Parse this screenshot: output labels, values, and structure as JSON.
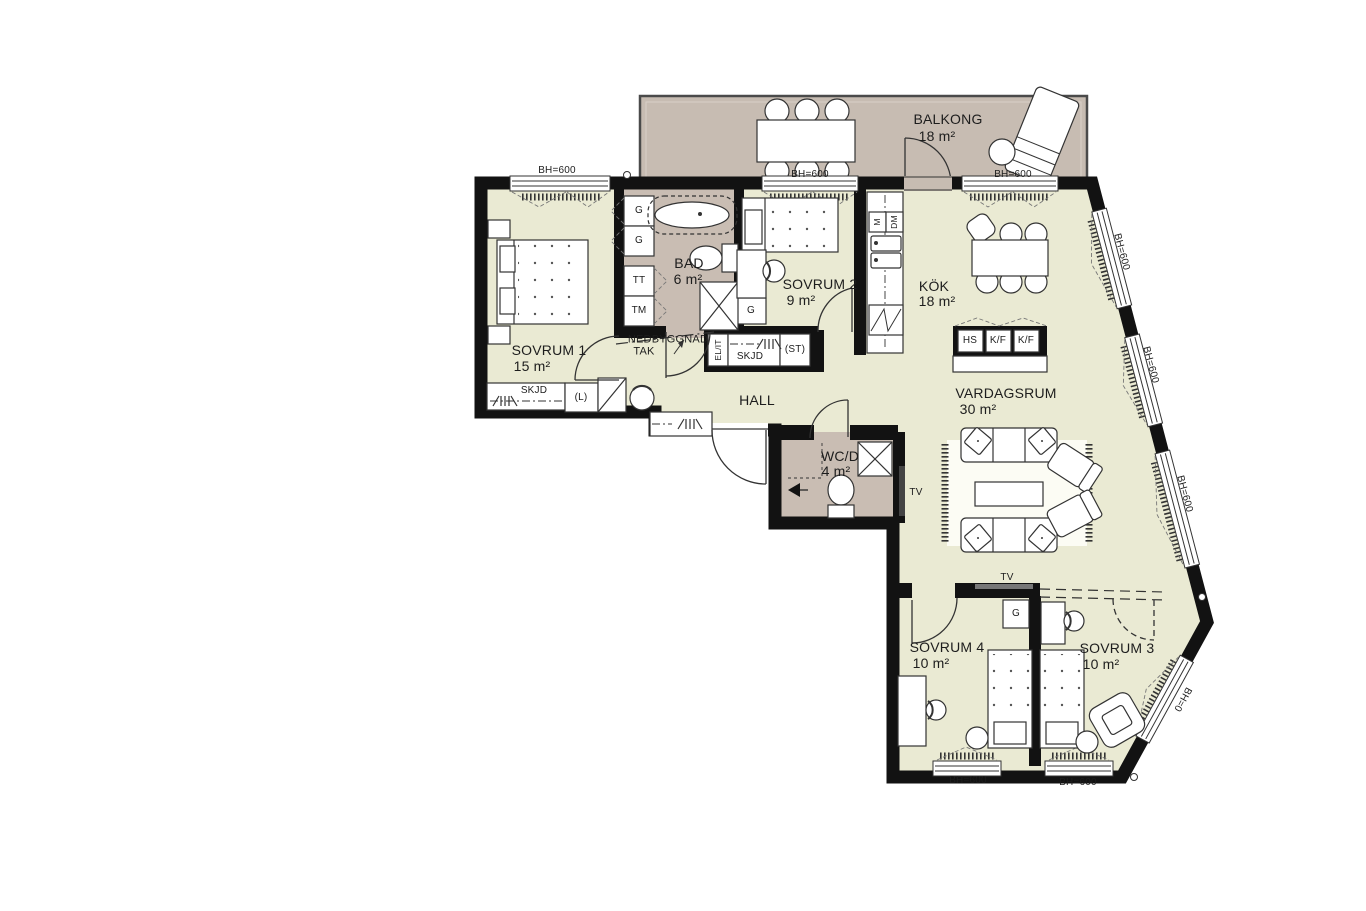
{
  "plan": {
    "rooms": {
      "balkong": {
        "name": "BALKONG",
        "area": "18 m²"
      },
      "sovrum1": {
        "name": "SOVRUM 1",
        "area": "15 m²"
      },
      "bad": {
        "name": "BAD",
        "area": "6 m²"
      },
      "sovrum2": {
        "name": "SOVRUM 2",
        "area": "9 m²"
      },
      "kok": {
        "name": "KÖK",
        "area": "18 m²"
      },
      "hall": {
        "name": "HALL"
      },
      "vardagsrum": {
        "name": "VARDAGSRUM",
        "area": "30 m²"
      },
      "wcd": {
        "name": "WC/D",
        "area": "4 m²"
      },
      "sovrum4": {
        "name": "SOVRUM 4",
        "area": "10 m²"
      },
      "sovrum3": {
        "name": "SOVRUM 3",
        "area": "10 m²"
      }
    },
    "labels": {
      "bh600": "BH=600",
      "bh0": "BH=0",
      "nedbyggnad_line1": "NEDBYGGNAD",
      "nedbyggnad_line2": "TAK",
      "skjd": "SKJD",
      "linen": "(L)",
      "st": "(ST)",
      "el_it": "EL/IT",
      "tv": "TV",
      "g": "G",
      "tt": "TT",
      "tm": "TM",
      "m": "M",
      "dm": "DM",
      "hs": "HS",
      "kf": "K/F"
    },
    "colors": {
      "floor": "#EAEAD3",
      "wet_room": "#C9BDB3",
      "balcony": "#C7BCB2",
      "wall": "#121212"
    }
  }
}
